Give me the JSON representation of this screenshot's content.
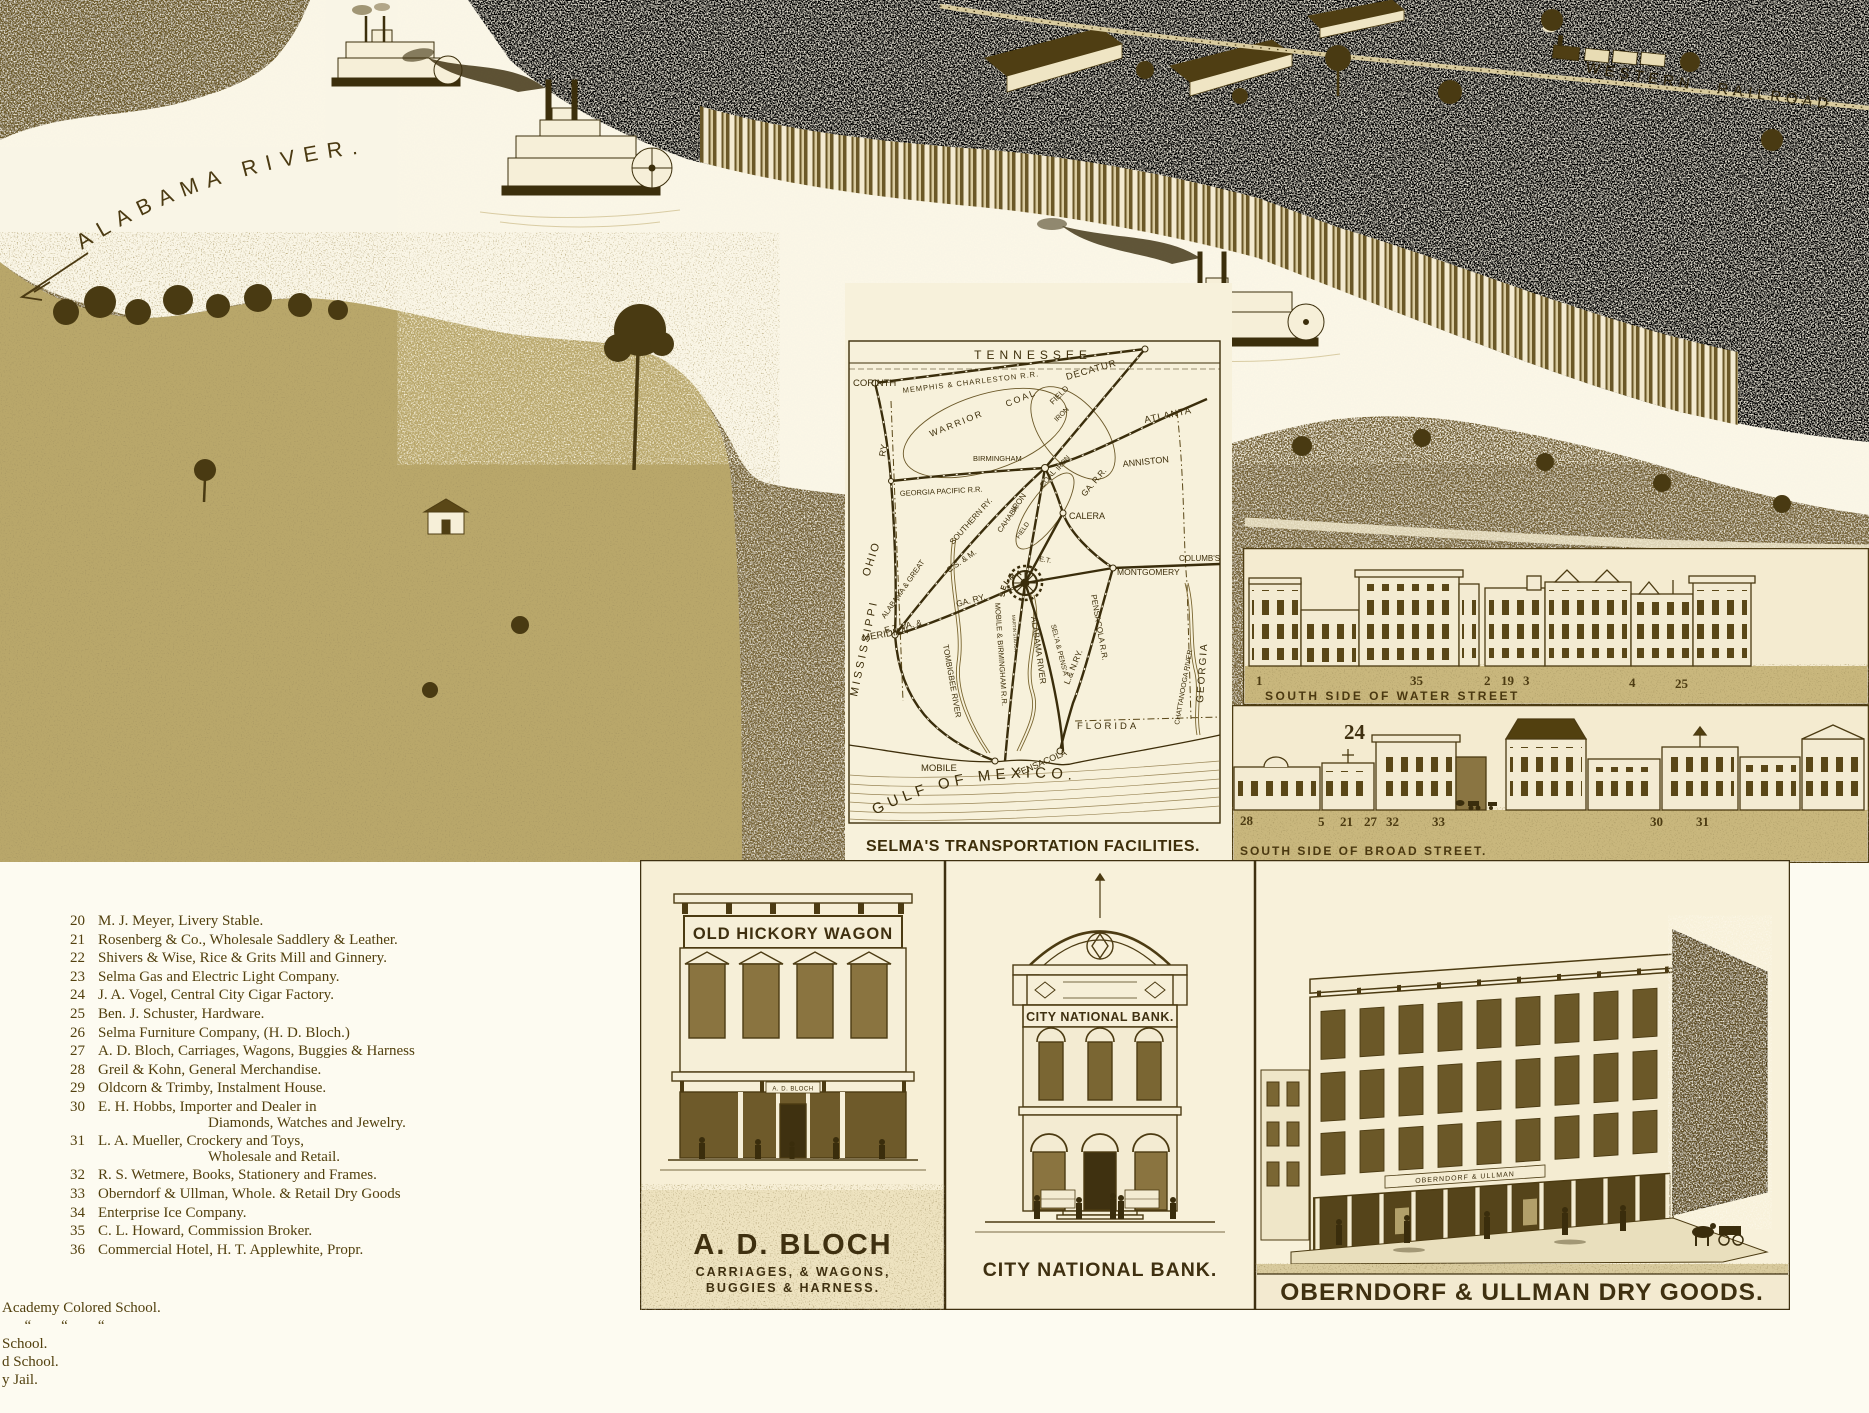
{
  "panorama": {
    "river_label": "ALABAMA  RIVER.",
    "railroad_label": "WESTERN  RAILROAD"
  },
  "map": {
    "caption": "SELMA'S TRANSPORTATION FACILITIES.",
    "labels": {
      "tennessee": "TENNESSEE",
      "corinth": "CORINTH",
      "memphis": "MEMPHIS & CHARLESTON R.R.",
      "decatur": "DECATUR",
      "atlanta": "ATLANTA",
      "anniston": "ANNISTON",
      "birmingham": "BIRMINGHAM",
      "ga_pacific": "GEORGIA PACIFIC R.R.",
      "warrior": "WARRIOR",
      "coal_a": "COAL",
      "field_a": "FIELD",
      "iron_a": "IRON",
      "iron_b": "IRON",
      "coal_b": "COAL",
      "iron_c": "IRON",
      "cahaba": "CAHABA",
      "field_b": "FIELD",
      "ga_rr": "GA. R.R.",
      "calera": "CALERA",
      "ry": "RY.",
      "ohio": "OHIO",
      "mississippi": "MISSISSIPPI",
      "meridian": "MERIDIAN",
      "southern": "SOUTHERN RY.",
      "ala_great": "ALABAMA & GREAT",
      "csm": "C.S. & M.",
      "etva": "E.T. VA. &",
      "ga_ry": "GA. RY.",
      "et": "E.T.",
      "selma": "SELMA",
      "montgomery": "MONTGOMERY",
      "columbus": "COLUMB'S",
      "ln": "L.& N.RY.",
      "mobile_bham": "MOBILE & BIRMINGHAM R.R.",
      "martin": "MARTIN STATION",
      "alabama_river": "ALABAMA RIVER",
      "sela_pensa": "SEL'A & PENS'A",
      "pensacola_rr": "PENSACOLA R.R.",
      "tombigbee": "TOMBIGBEE RIVER",
      "mobile": "MOBILE",
      "pensacola": "PENSACOLA",
      "florida": "FLORIDA",
      "georgia": "GEORGIA",
      "chattanooga": "CHATTANOOGA RIVER",
      "gulf": "GULF  OF  MEXICO."
    }
  },
  "water_street": {
    "caption": "SOUTH SIDE OF WATER STREET",
    "numbers": [
      "1",
      "35",
      "2",
      "19",
      "3",
      "4",
      "25"
    ]
  },
  "broad_street": {
    "caption": "SOUTH SIDE OF BROAD STREET.",
    "big_number": "24",
    "numbers": [
      "28",
      "5",
      "21",
      "27",
      "32",
      "33",
      "30",
      "31"
    ]
  },
  "legend": {
    "items": [
      {
        "num": "20",
        "text": "M. J. Meyer, Livery Stable."
      },
      {
        "num": "21",
        "text": "Rosenberg & Co., Wholesale Saddlery & Leather."
      },
      {
        "num": "22",
        "text": "Shivers & Wise, Rice & Grits Mill and Ginnery."
      },
      {
        "num": "23",
        "text": "Selma Gas and Electric Light Company."
      },
      {
        "num": "24",
        "text": "J. A. Vogel, Central City Cigar Factory."
      },
      {
        "num": "25",
        "text": "Ben. J. Schuster, Hardware."
      },
      {
        "num": "26",
        "text": "Selma Furniture Company, (H. D. Bloch.)"
      },
      {
        "num": "27",
        "text": "A. D. Bloch, Carriages, Wagons, Buggies & Harness"
      },
      {
        "num": "28",
        "text": "Greil & Kohn, General Merchandise."
      },
      {
        "num": "29",
        "text": "Oldcorn & Trimby, Instalment House."
      },
      {
        "num": "30",
        "text": "E. H. Hobbs, Importer and Dealer in",
        "cont": "Diamonds, Watches and Jewelry."
      },
      {
        "num": "31",
        "text": "L. A. Mueller, Crockery and Toys,",
        "cont": "Wholesale and Retail."
      },
      {
        "num": "32",
        "text": "R. S. Wetmere, Books, Stationery and Frames."
      },
      {
        "num": "33",
        "text": "Oberndorf & Ullman, Whole. & Retail Dry Goods"
      },
      {
        "num": "34",
        "text": "Enterprise Ice Company."
      },
      {
        "num": "35",
        "text": "C. L. Howard, Commission Broker."
      },
      {
        "num": "36",
        "text": "Commercial Hotel, H. T. Applewhite, Propr."
      }
    ]
  },
  "corner_notes": {
    "lines": [
      "Academy Colored School.",
      "      “        “        “",
      "School.",
      "d School.",
      "y Jail."
    ]
  },
  "vignettes": {
    "bloch": {
      "sign": "OLD HICKORY WAGON",
      "door_sign": "A. D. BLOCH",
      "caption1": "A. D. BLOCH",
      "caption2": "CARRIAGES,  &  WAGONS,",
      "caption3": "BUGGIES  &  HARNESS."
    },
    "bank": {
      "facade_sign": "CITY NATIONAL BANK.",
      "caption": "CITY NATIONAL BANK."
    },
    "oberndorf": {
      "building_sign": "OBERNDORF & ULLMAN",
      "caption": "OBERNDORF & ULLMAN DRY GOODS."
    }
  }
}
